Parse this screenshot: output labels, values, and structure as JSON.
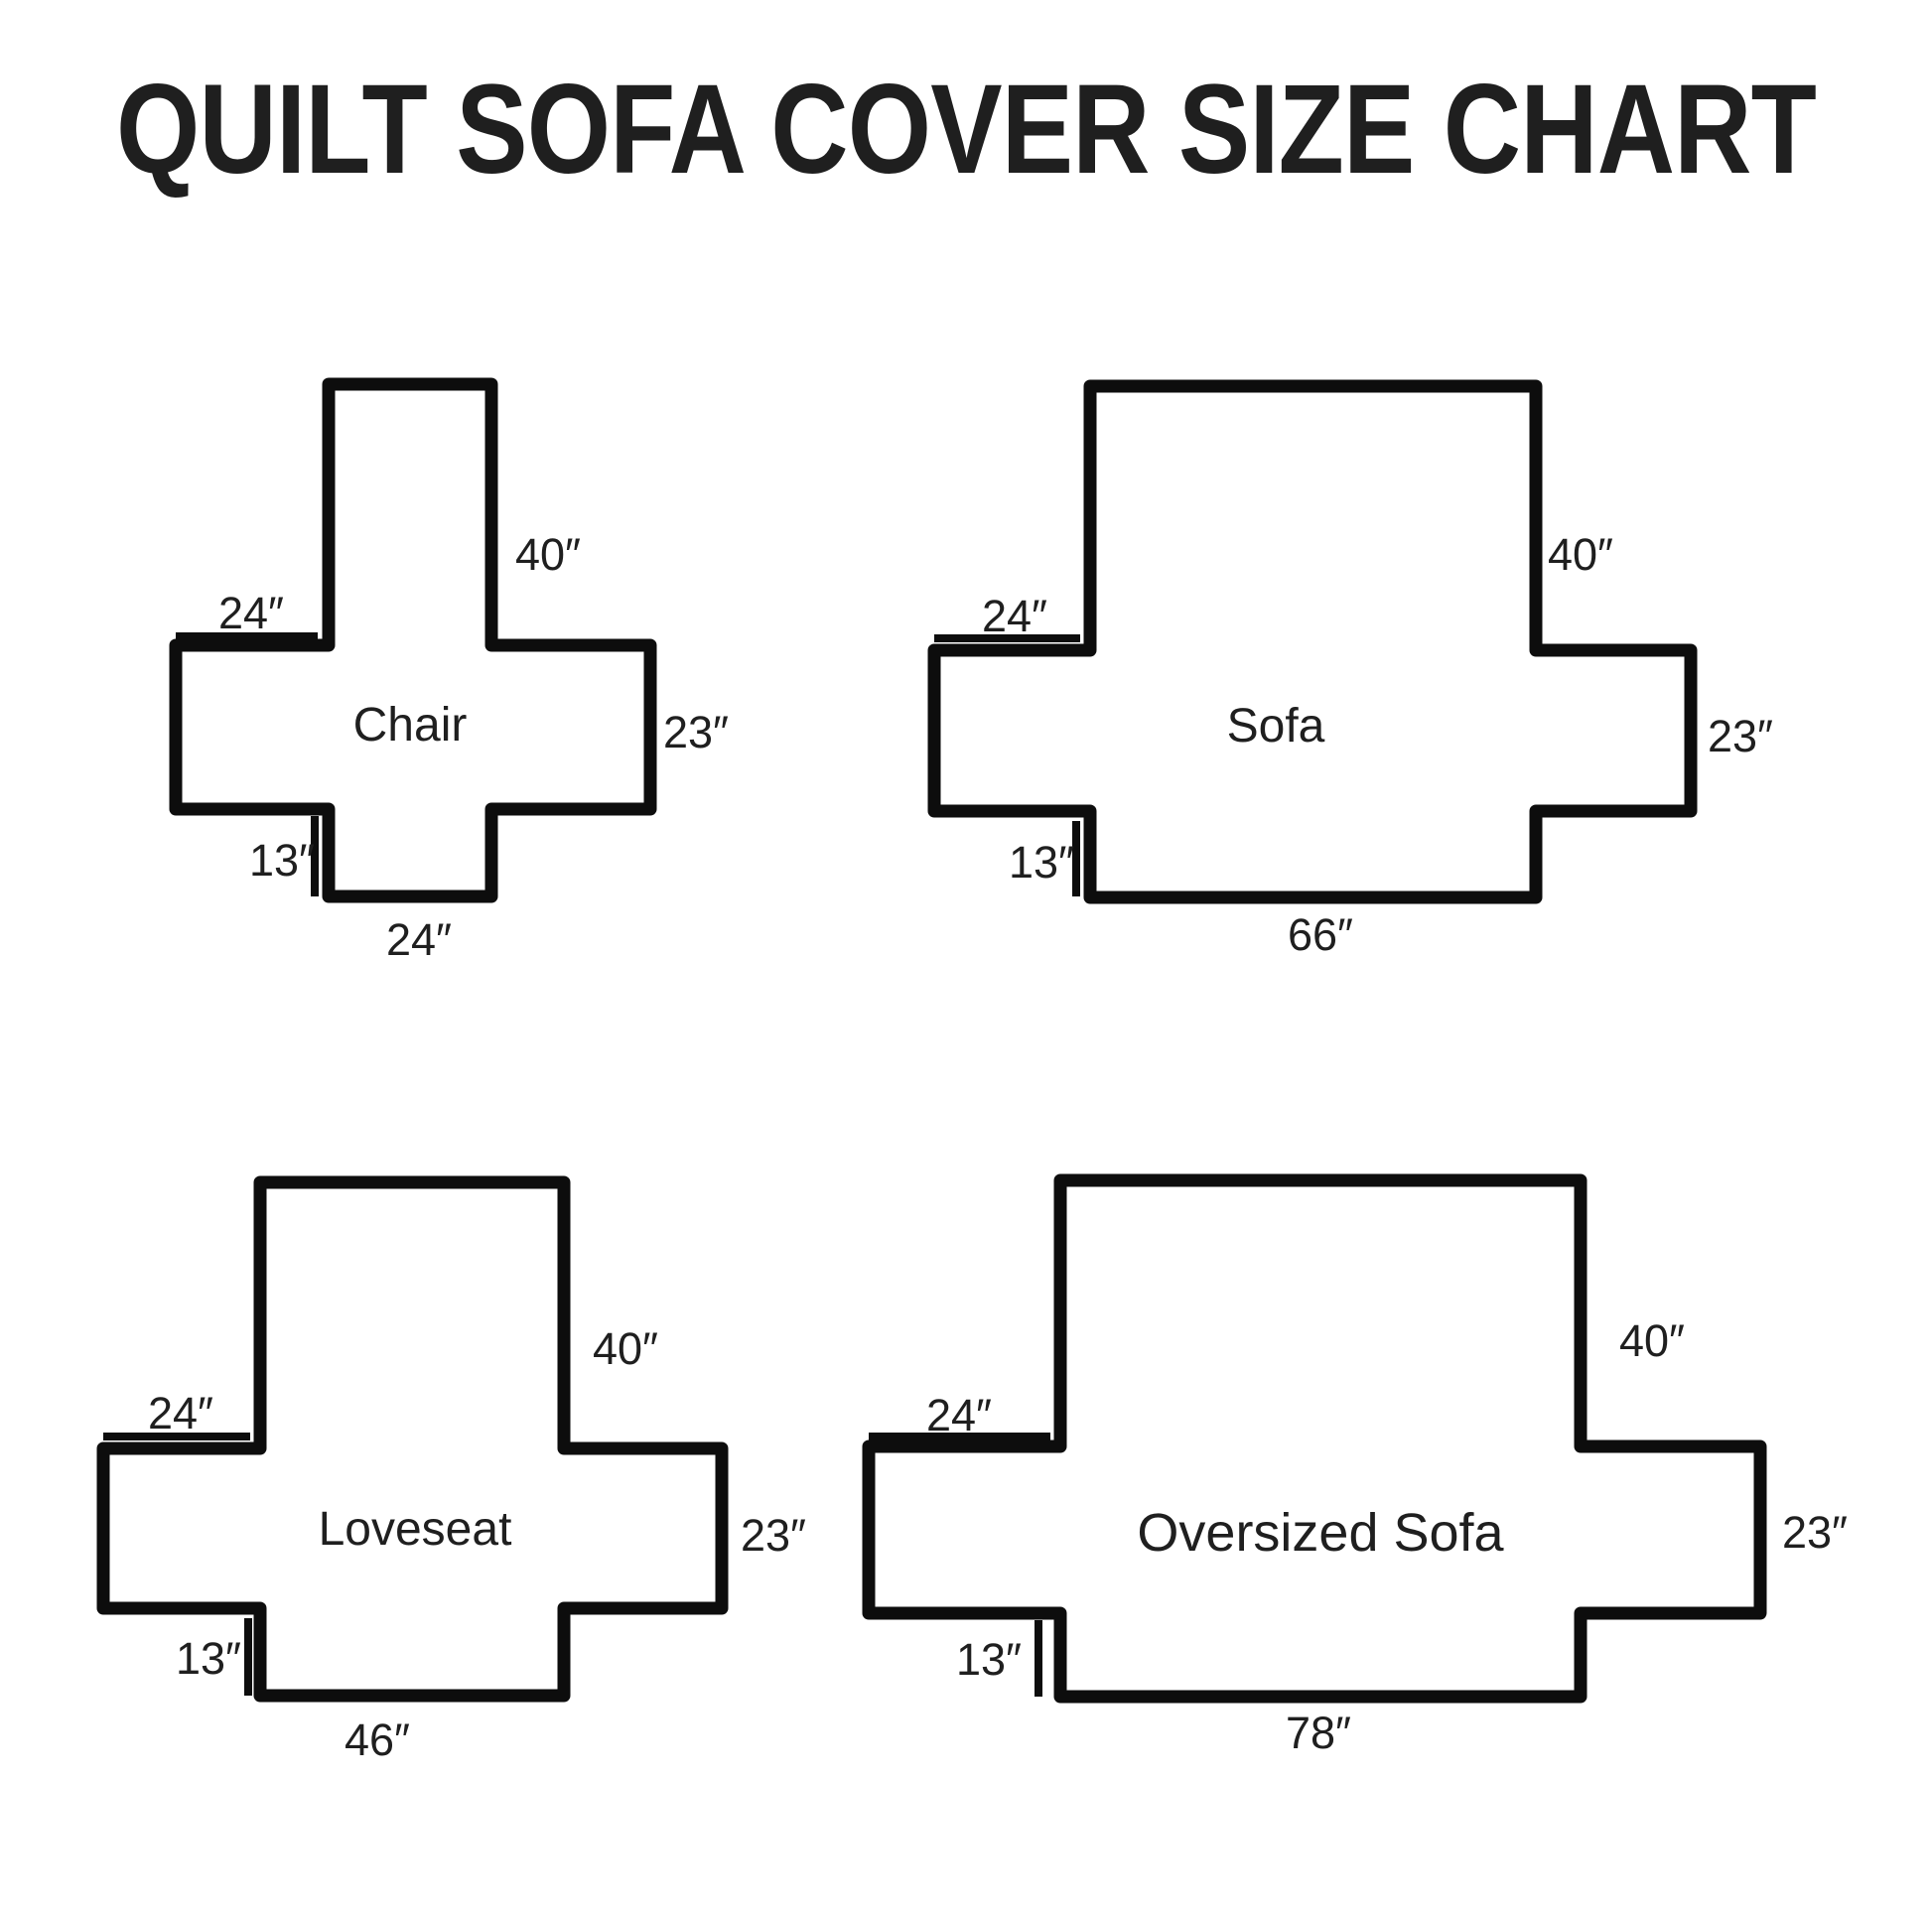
{
  "title": "QUILT SOFA COVER SIZE CHART",
  "colors": {
    "background": "#ffffff",
    "line": "#0d0d0d",
    "text": "#1f1f1f"
  },
  "diagrams": [
    {
      "name": "Chair",
      "back_height": "40″",
      "arm_depth": "24″",
      "arm_height": "23″",
      "flap_drop": "13″",
      "bottom_width": "24″"
    },
    {
      "name": "Sofa",
      "back_height": "40″",
      "arm_depth": "24″",
      "arm_height": "23″",
      "flap_drop": "13″",
      "bottom_width": "66″"
    },
    {
      "name": "Loveseat",
      "back_height": "40″",
      "arm_depth": "24″",
      "arm_height": "23″",
      "flap_drop": "13″",
      "bottom_width": "46″"
    },
    {
      "name": "Oversized Sofa",
      "back_height": "40″",
      "arm_depth": "24″",
      "arm_height": "23″",
      "flap_drop": "13″",
      "bottom_width": "78″"
    }
  ]
}
